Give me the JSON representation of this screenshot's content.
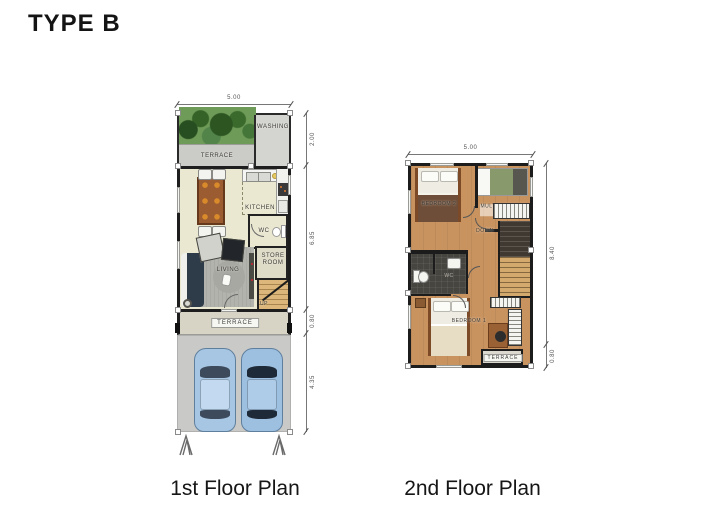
{
  "title": "TYPE B",
  "palette": {
    "wall": "#1c1c1c",
    "floor_cream": "#eae8d0",
    "floor_wood": "#c9935f",
    "terrace_gray": "#cbcbc7",
    "garden_green": "#6f9b58",
    "carport_gray": "#c9c9c7",
    "car_blue": "#a6c6e3",
    "sofa_navy": "#2e3b49",
    "dining_table_brown": "#9a5c30",
    "stairs_tan": "#d9b375",
    "wc_dark": "#47453f",
    "dimension_line": "#777777"
  },
  "first_floor": {
    "caption": "1st Floor Plan",
    "dim_width": "5.00",
    "dim_heights": {
      "top_section": "2.00",
      "main": "6.85",
      "terrace": "0.80",
      "carport": "4.35"
    },
    "rooms": {
      "terrace_garden": "TERRACE",
      "washing": "WASHING",
      "kitchen": "KITCHEN",
      "dining": "DINING",
      "wc": "WC",
      "store_room": "STORE ROOM",
      "living": "LIVING",
      "stairs_up": "UP",
      "terrace_front": "TERRACE"
    }
  },
  "second_floor": {
    "caption": "2nd Floor Plan",
    "dim_width": "5.00",
    "dim_heights": {
      "main": "8.40",
      "terrace": "0.80"
    },
    "rooms": {
      "bedroom2": "BEDROOM 2",
      "multipurpose": "MULTIPURPOSE ROOM",
      "stairs_down": "DOWN",
      "wc": "WC",
      "bedroom1": "BEDROOM 1",
      "terrace": "TERRACE"
    }
  }
}
